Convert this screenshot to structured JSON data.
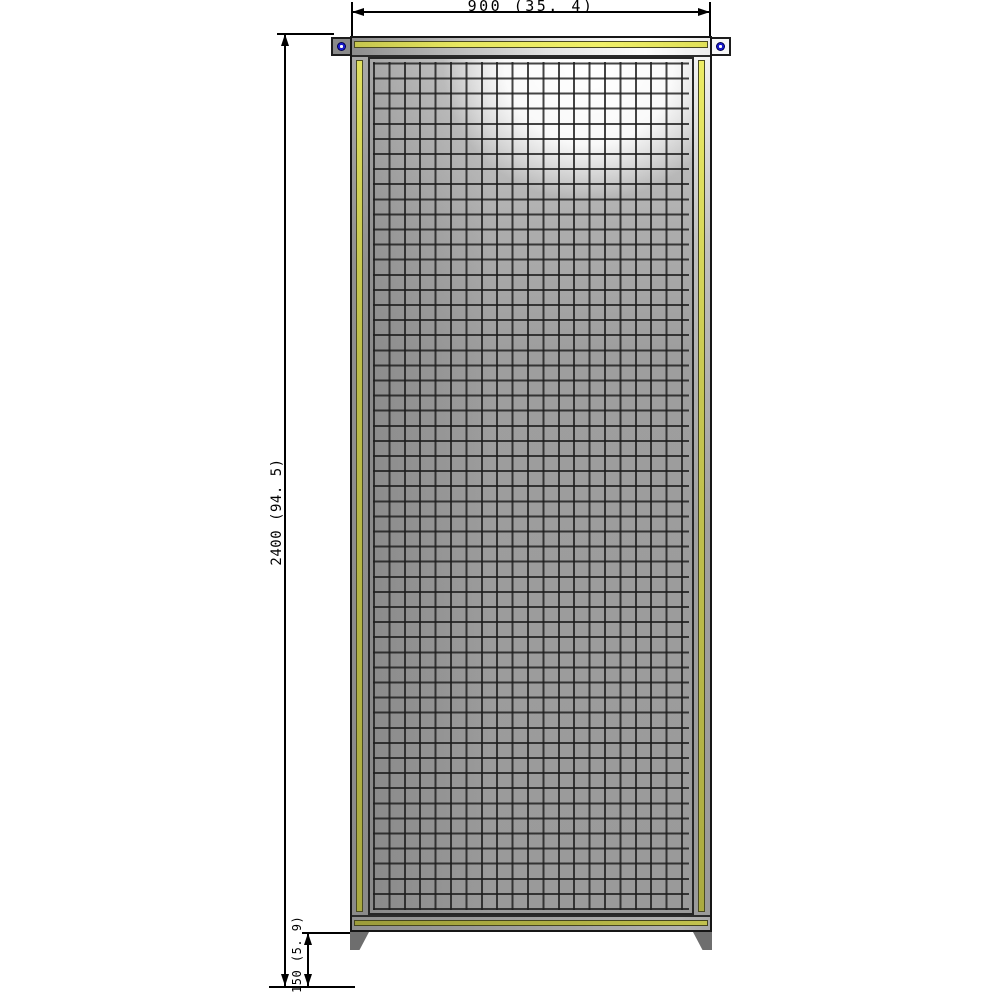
{
  "drawing": {
    "type": "cad-front-view",
    "subject": "wire mesh machine-guard fence panel with hanger brackets and floor feet",
    "dimensions": {
      "width": {
        "label": "900 (35. 4)",
        "value_mm": 900,
        "value_in": 35.4
      },
      "height": {
        "label": "2400 (94. 5)",
        "value_mm": 2400,
        "value_in": 94.5
      },
      "floor_clearance": {
        "label": "150 (5. 9)",
        "value_mm": 150,
        "value_in": 5.9
      }
    },
    "colors": {
      "stripe_yellow_bright": "#e8e860",
      "stripe_olive": "#aaaa40",
      "panel_gray": "#9a9a9a",
      "rail_highlight": "#fdfdfd",
      "mounting_hole_blue": "#1818c8",
      "line_black": "#000000",
      "background": "#ffffff"
    }
  }
}
